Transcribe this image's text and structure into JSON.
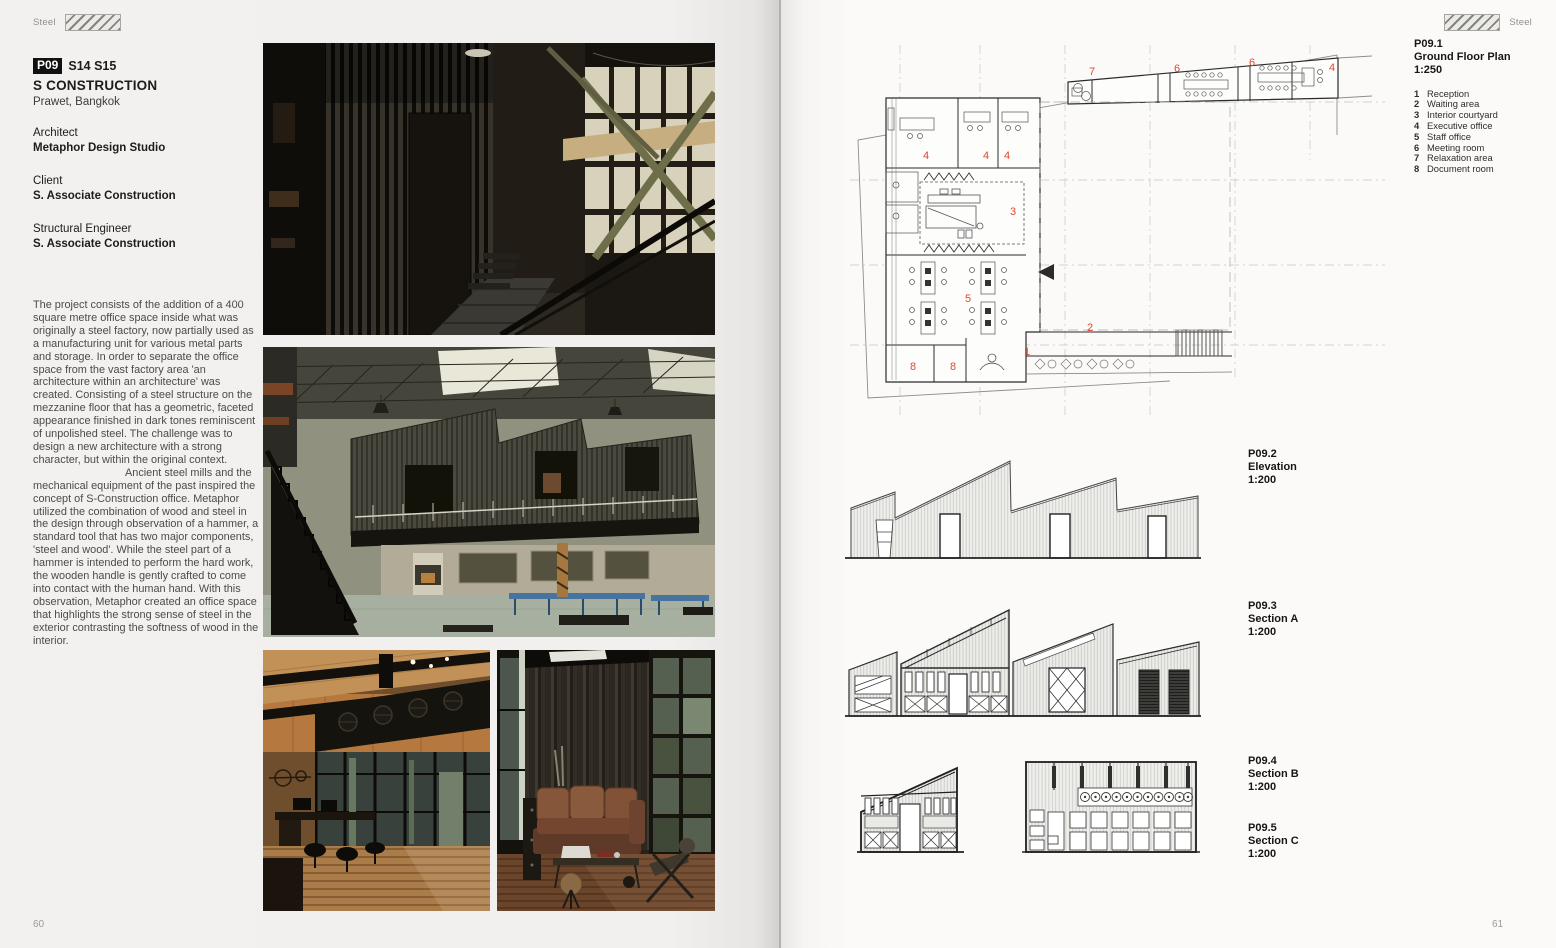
{
  "page_left": {
    "header": {
      "label": "Steel"
    },
    "page_number": "60",
    "project": {
      "badge": "P09",
      "codes": "S14 S15",
      "title": "S CONSTRUCTION",
      "location": "Prawet, Bangkok",
      "roles": [
        {
          "role": "Architect",
          "name": "Metaphor Design Studio"
        },
        {
          "role": "Client",
          "name": "S. Associate Construction"
        },
        {
          "role": "Structural Engineer",
          "name": "S. Associate Construction"
        }
      ]
    },
    "body": {
      "paragraph_1": "The project consists of the addition of a 400 square metre office space inside what was originally a steel factory, now partially used as a manufacturing unit for various metal parts and storage. In order to separate the office space from the vast factory area 'an architecture within an architecture' was created. Consisting of a steel structure on the mezzanine floor that has a geometric, faceted appearance finished in dark tones reminiscent of unpolished steel. The challenge was to design a new architecture with a strong character, but within the original context.",
      "paragraph_2": "Ancient steel mills and the mechanical equipment of the past inspired the concept of S-Construction office. Metaphor utilized the combination of wood and steel in the design through observation of a hammer, a standard tool that has two major components, 'steel and wood'. While the steel part of a hammer is intended to perform the hard work, the wooden handle is gently crafted to come into contact with the human hand. With this observation, Metaphor created an office space that highlights the strong sense of steel in the exterior contrasting the softness of wood in the interior."
    }
  },
  "page_right": {
    "header": {
      "label": "Steel"
    },
    "page_number": "61",
    "figures": [
      {
        "id": "P09.1",
        "title": "Ground Floor Plan",
        "scale": "1:250"
      },
      {
        "id": "P09.2",
        "title": "Elevation",
        "scale": "1:200"
      },
      {
        "id": "P09.3",
        "title": "Section A",
        "scale": "1:200"
      },
      {
        "id": "P09.4",
        "title": "Section B",
        "scale": "1:200"
      },
      {
        "id": "P09.5",
        "title": "Section C",
        "scale": "1:200"
      }
    ],
    "legend": [
      {
        "num": "1",
        "label": "Reception"
      },
      {
        "num": "2",
        "label": "Waiting area"
      },
      {
        "num": "3",
        "label": "Interior courtyard"
      },
      {
        "num": "4",
        "label": "Executive office"
      },
      {
        "num": "5",
        "label": "Staff office"
      },
      {
        "num": "6",
        "label": "Meeting room"
      },
      {
        "num": "7",
        "label": "Relaxation area"
      },
      {
        "num": "8",
        "label": "Document room"
      }
    ],
    "plan_labels": [
      "7",
      "6",
      "6",
      "4",
      "4",
      "4",
      "4",
      "3",
      "5",
      "2",
      "1",
      "8",
      "8"
    ],
    "colors": {
      "plan_number_accent": "#e0472e"
    }
  }
}
